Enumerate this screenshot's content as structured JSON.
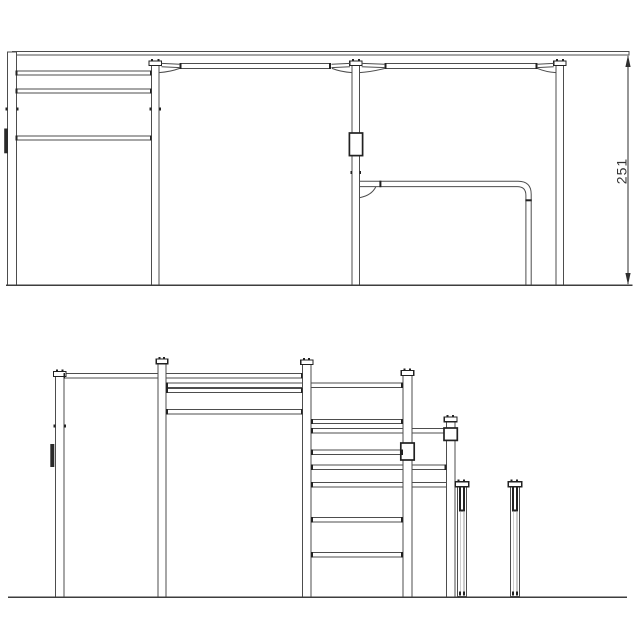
{
  "dimension": {
    "value": "251"
  },
  "colors": {
    "background": "#ffffff",
    "line": "#4d4d4d",
    "dark_detail": "#222222",
    "ground": "#3d3d3d",
    "dimension": "#2e2e2e"
  }
}
